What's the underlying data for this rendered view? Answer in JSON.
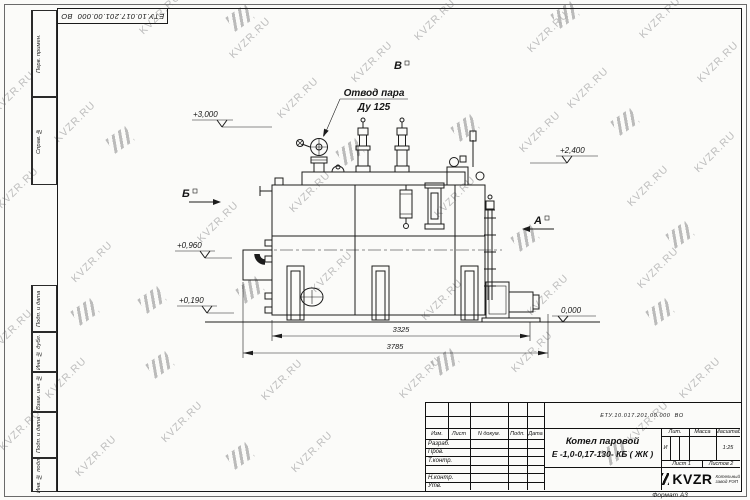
{
  "watermark": {
    "text": "KVZR.RU",
    "color": "#b3b3b3",
    "text_positions": [
      [
        160,
        14
      ],
      [
        250,
        38
      ],
      [
        435,
        20
      ],
      [
        548,
        32
      ],
      [
        660,
        18
      ],
      [
        718,
        62
      ],
      [
        75,
        122
      ],
      [
        14,
        92
      ],
      [
        18,
        188
      ],
      [
        298,
        98
      ],
      [
        372,
        62
      ],
      [
        588,
        88
      ],
      [
        540,
        132
      ],
      [
        648,
        186
      ],
      [
        715,
        152
      ],
      [
        92,
        262
      ],
      [
        310,
        192
      ],
      [
        455,
        197
      ],
      [
        218,
        222
      ],
      [
        332,
        272
      ],
      [
        442,
        300
      ],
      [
        548,
        295
      ],
      [
        658,
        268
      ],
      [
        12,
        330
      ],
      [
        66,
        378
      ],
      [
        182,
        422
      ],
      [
        96,
        456
      ],
      [
        282,
        380
      ],
      [
        312,
        452
      ],
      [
        420,
        378
      ],
      [
        532,
        352
      ],
      [
        648,
        422
      ],
      [
        700,
        378
      ],
      [
        20,
        430
      ]
    ],
    "logo_positions": [
      [
        240,
        18
      ],
      [
        565,
        15
      ],
      [
        120,
        140
      ],
      [
        350,
        152
      ],
      [
        465,
        128
      ],
      [
        625,
        122
      ],
      [
        152,
        300
      ],
      [
        250,
        290
      ],
      [
        85,
        312
      ],
      [
        525,
        238
      ],
      [
        680,
        235
      ],
      [
        660,
        312
      ],
      [
        160,
        365
      ],
      [
        240,
        456
      ],
      [
        445,
        362
      ],
      [
        615,
        452
      ]
    ]
  },
  "frame": {
    "top_stamp": "ЕТУ.10.017.201.00.000  ВО",
    "side_labels": {
      "perv": "Перв. примен.",
      "sprav": "Справ. №",
      "podp1": "Подп. и дата",
      "inv_dubl": "Инв. № дубл.",
      "vzam": "Взам. инв. №",
      "podp2": "Подп. и дата",
      "inv_podl": "Инв. № подл."
    }
  },
  "drawing": {
    "callout_line1": "Отвод пара",
    "callout_line2": "Ду 125",
    "elev_3000": "+3,000",
    "elev_2400": "+2,400",
    "elev_0960": "+0,960",
    "elev_0190": "+0,190",
    "elev_0000": "0,000",
    "view_b": "Б",
    "view_v": "В",
    "view_a": "А",
    "dim_3325": "3325",
    "dim_3785": "3785"
  },
  "title_block": {
    "doc_number": "ЕТУ.10.017.201.00.000  ВО",
    "product_name_line1": "Котел паровой",
    "product_name_line2": "Е -1,0-0,17-130- КБ ( ЖК )",
    "col_izm": "Изм.",
    "col_list": "Лист",
    "col_ndocum": "N докум.",
    "col_podp": "Подп.",
    "col_data": "Дата",
    "row_razrab": "Разраб.",
    "row_prov": "Пров.",
    "row_tkontr": "Т.контр.",
    "row_nkontr": "Н.контр.",
    "row_utv": "Утв.",
    "lit_label": "Лит.",
    "lit_value": "И",
    "massa_label": "Масса",
    "masshtab_label": "Масштаб",
    "masshtab_value": "1:25",
    "list_label": "Лист 1",
    "listov_label": "Листов 2",
    "logo_text": "KVZR",
    "logo_sub1": "Котельный",
    "logo_sub2": "завод РЭП",
    "format_label": "Формат А3"
  }
}
